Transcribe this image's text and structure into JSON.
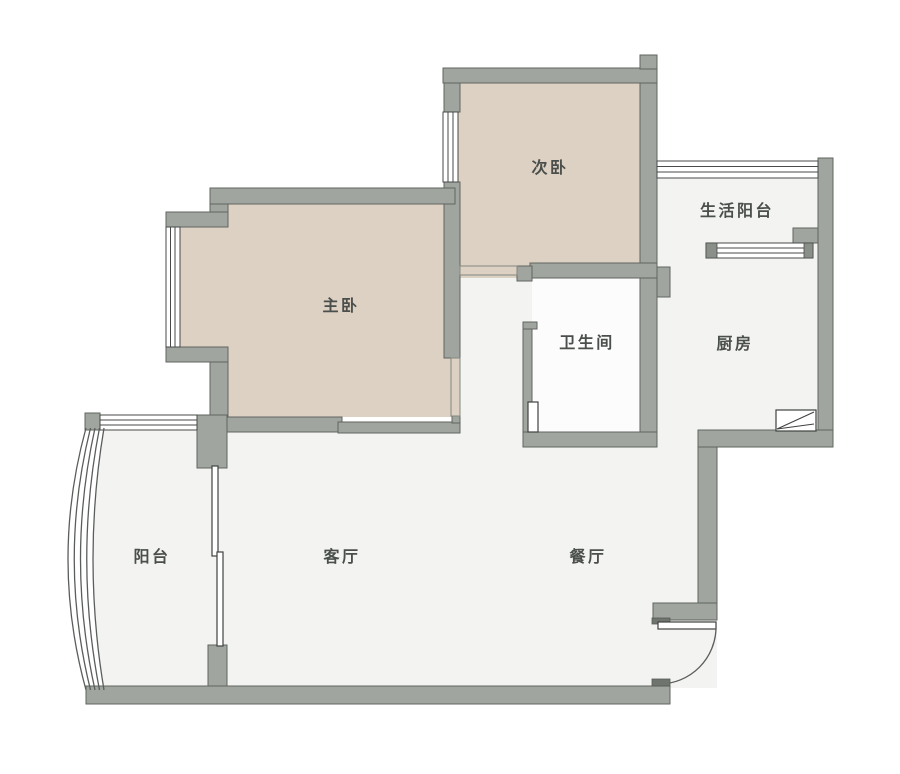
{
  "plan": {
    "type": "apartment-floor-plan",
    "rooms": [
      {
        "id": "master-bedroom",
        "label": "主卧"
      },
      {
        "id": "second-bedroom",
        "label": "次卧"
      },
      {
        "id": "service-balcony",
        "label": "生活阳台"
      },
      {
        "id": "bathroom",
        "label": "卫生间"
      },
      {
        "id": "kitchen",
        "label": "厨房"
      },
      {
        "id": "balcony",
        "label": "阳台"
      },
      {
        "id": "living-room",
        "label": "客厅"
      },
      {
        "id": "dining-room",
        "label": "餐厅"
      }
    ],
    "colors": {
      "background": "#ffffff",
      "wall": "#a1a5a0",
      "wall_outline": "#616560",
      "bedroom_floor": "#ddd1c3",
      "light_floor": "#f3f4f2",
      "bathroom_floor": "#fbfcfb",
      "window_frame": "#474a47",
      "label_text": "#4b4f4b"
    }
  }
}
